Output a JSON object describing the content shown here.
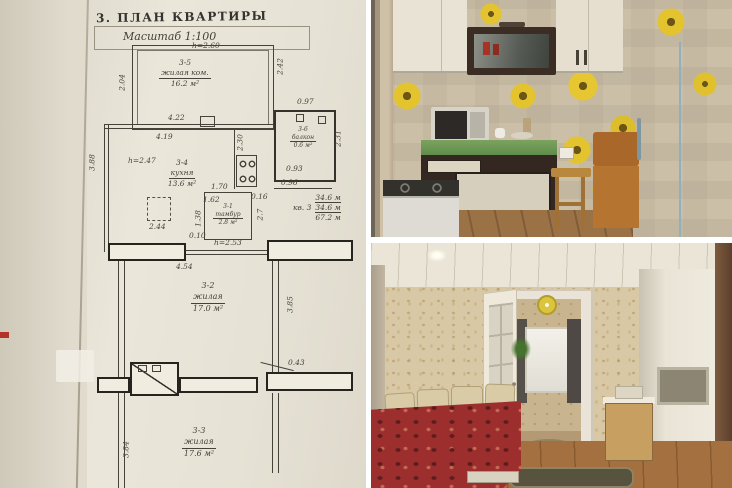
{
  "floor_plan": {
    "title": "3. ПЛАН КВАРТИРЫ",
    "scale": "Масштаб 1:100",
    "heights": {
      "top_room": "h=2.60",
      "kitchen": "h=2.47",
      "tambour": "h=2.53"
    },
    "rooms": [
      {
        "id": "3-5",
        "name": "жилая ком.",
        "area": "16.2 м²"
      },
      {
        "id": "3-4",
        "name": "кухня",
        "area": "13.6 м²"
      },
      {
        "id": "3-6",
        "name": "балкон",
        "area": "0.6 м²"
      },
      {
        "id": "3-1",
        "name": "тамбур",
        "area": "2.8 м²"
      },
      {
        "id": "3-2",
        "name": "жилая",
        "area": "17.0 м²"
      },
      {
        "id": "3-3",
        "name": "жилая",
        "area": "17.6 м²"
      }
    ],
    "summary": {
      "apartment": "кв. 3",
      "living": "34.6 м",
      "living_repeat": "34.6 м",
      "total": "67.2 м"
    },
    "dims": {
      "w422": "4.22",
      "w419": "4.19",
      "w097": "0.97",
      "w230": "2.30",
      "w231": "2.31",
      "w093": "0.93",
      "w096": "0.96",
      "w170": "1.70",
      "w162": "1.62",
      "w016": "0.16",
      "w27": "2.7",
      "w244": "2.44",
      "w010": "0.10",
      "w138": "1.38",
      "w454": "4.54",
      "w385": "3.85",
      "w043": "0.43",
      "w384": "3.84",
      "w388": "3.88",
      "w204": "2.04",
      "w242": "2.42"
    }
  },
  "palette": {
    "paper": "#e7e2d5",
    "plan_line": "#45423a",
    "wall_fill": "#f0ece0",
    "red_mark": "#b43227",
    "fridge_blue": "#abc8d2",
    "sunflower_yellow": "#e3c42f",
    "kitchen_cabinet_dark": "#3b2d23",
    "bedspread_red": "#9c2f2e",
    "wallpaper_beige": "#d9c8a5",
    "floor_wood": "#a5703f"
  }
}
